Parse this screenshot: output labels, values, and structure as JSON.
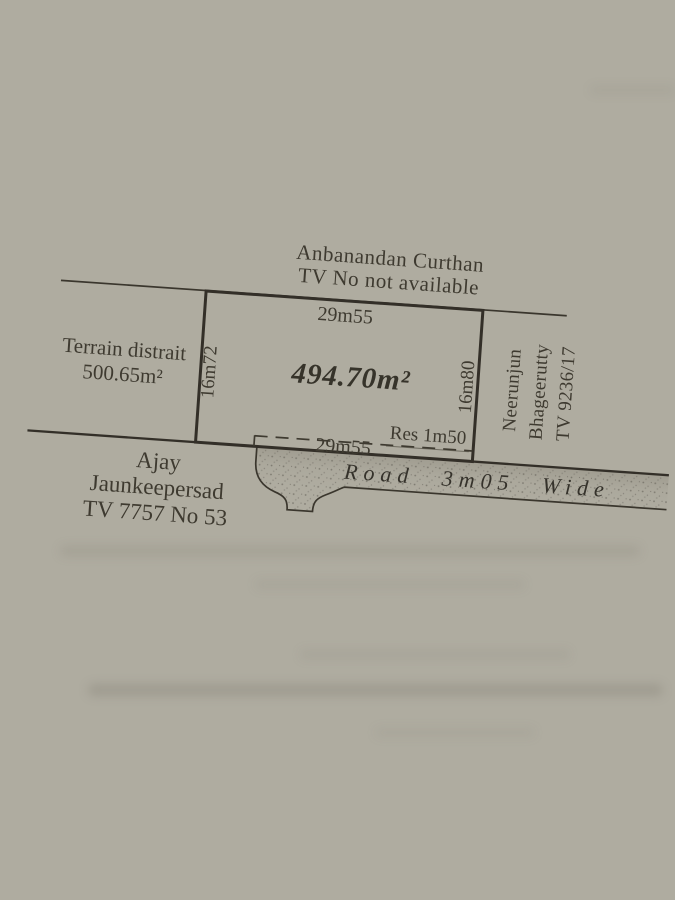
{
  "plan": {
    "north_neighbor": {
      "name": "Anbanandan Curthan",
      "tv": "TV No not available"
    },
    "west_neighbor": {
      "name": "Terrain distrait",
      "area": "500.65m²"
    },
    "south_neighbor": {
      "line1": "Ajay",
      "line2": "Jaunkeepersad",
      "line3": "TV 7757 No 53"
    },
    "east_neighbor": {
      "line1": "Neerunjun",
      "line2": "Bhageerutty",
      "line3": "TV 9236/17"
    },
    "plot": {
      "area": "494.70m²",
      "top_width": "29m55",
      "bottom_width": "29m55",
      "left_depth": "16m72",
      "right_depth": "16m80",
      "reserve": "Res 1m50"
    },
    "road": {
      "label": "Road 3m05 Wide"
    },
    "colors": {
      "paper": "#b0ada1",
      "ink": "#3a362d"
    }
  }
}
